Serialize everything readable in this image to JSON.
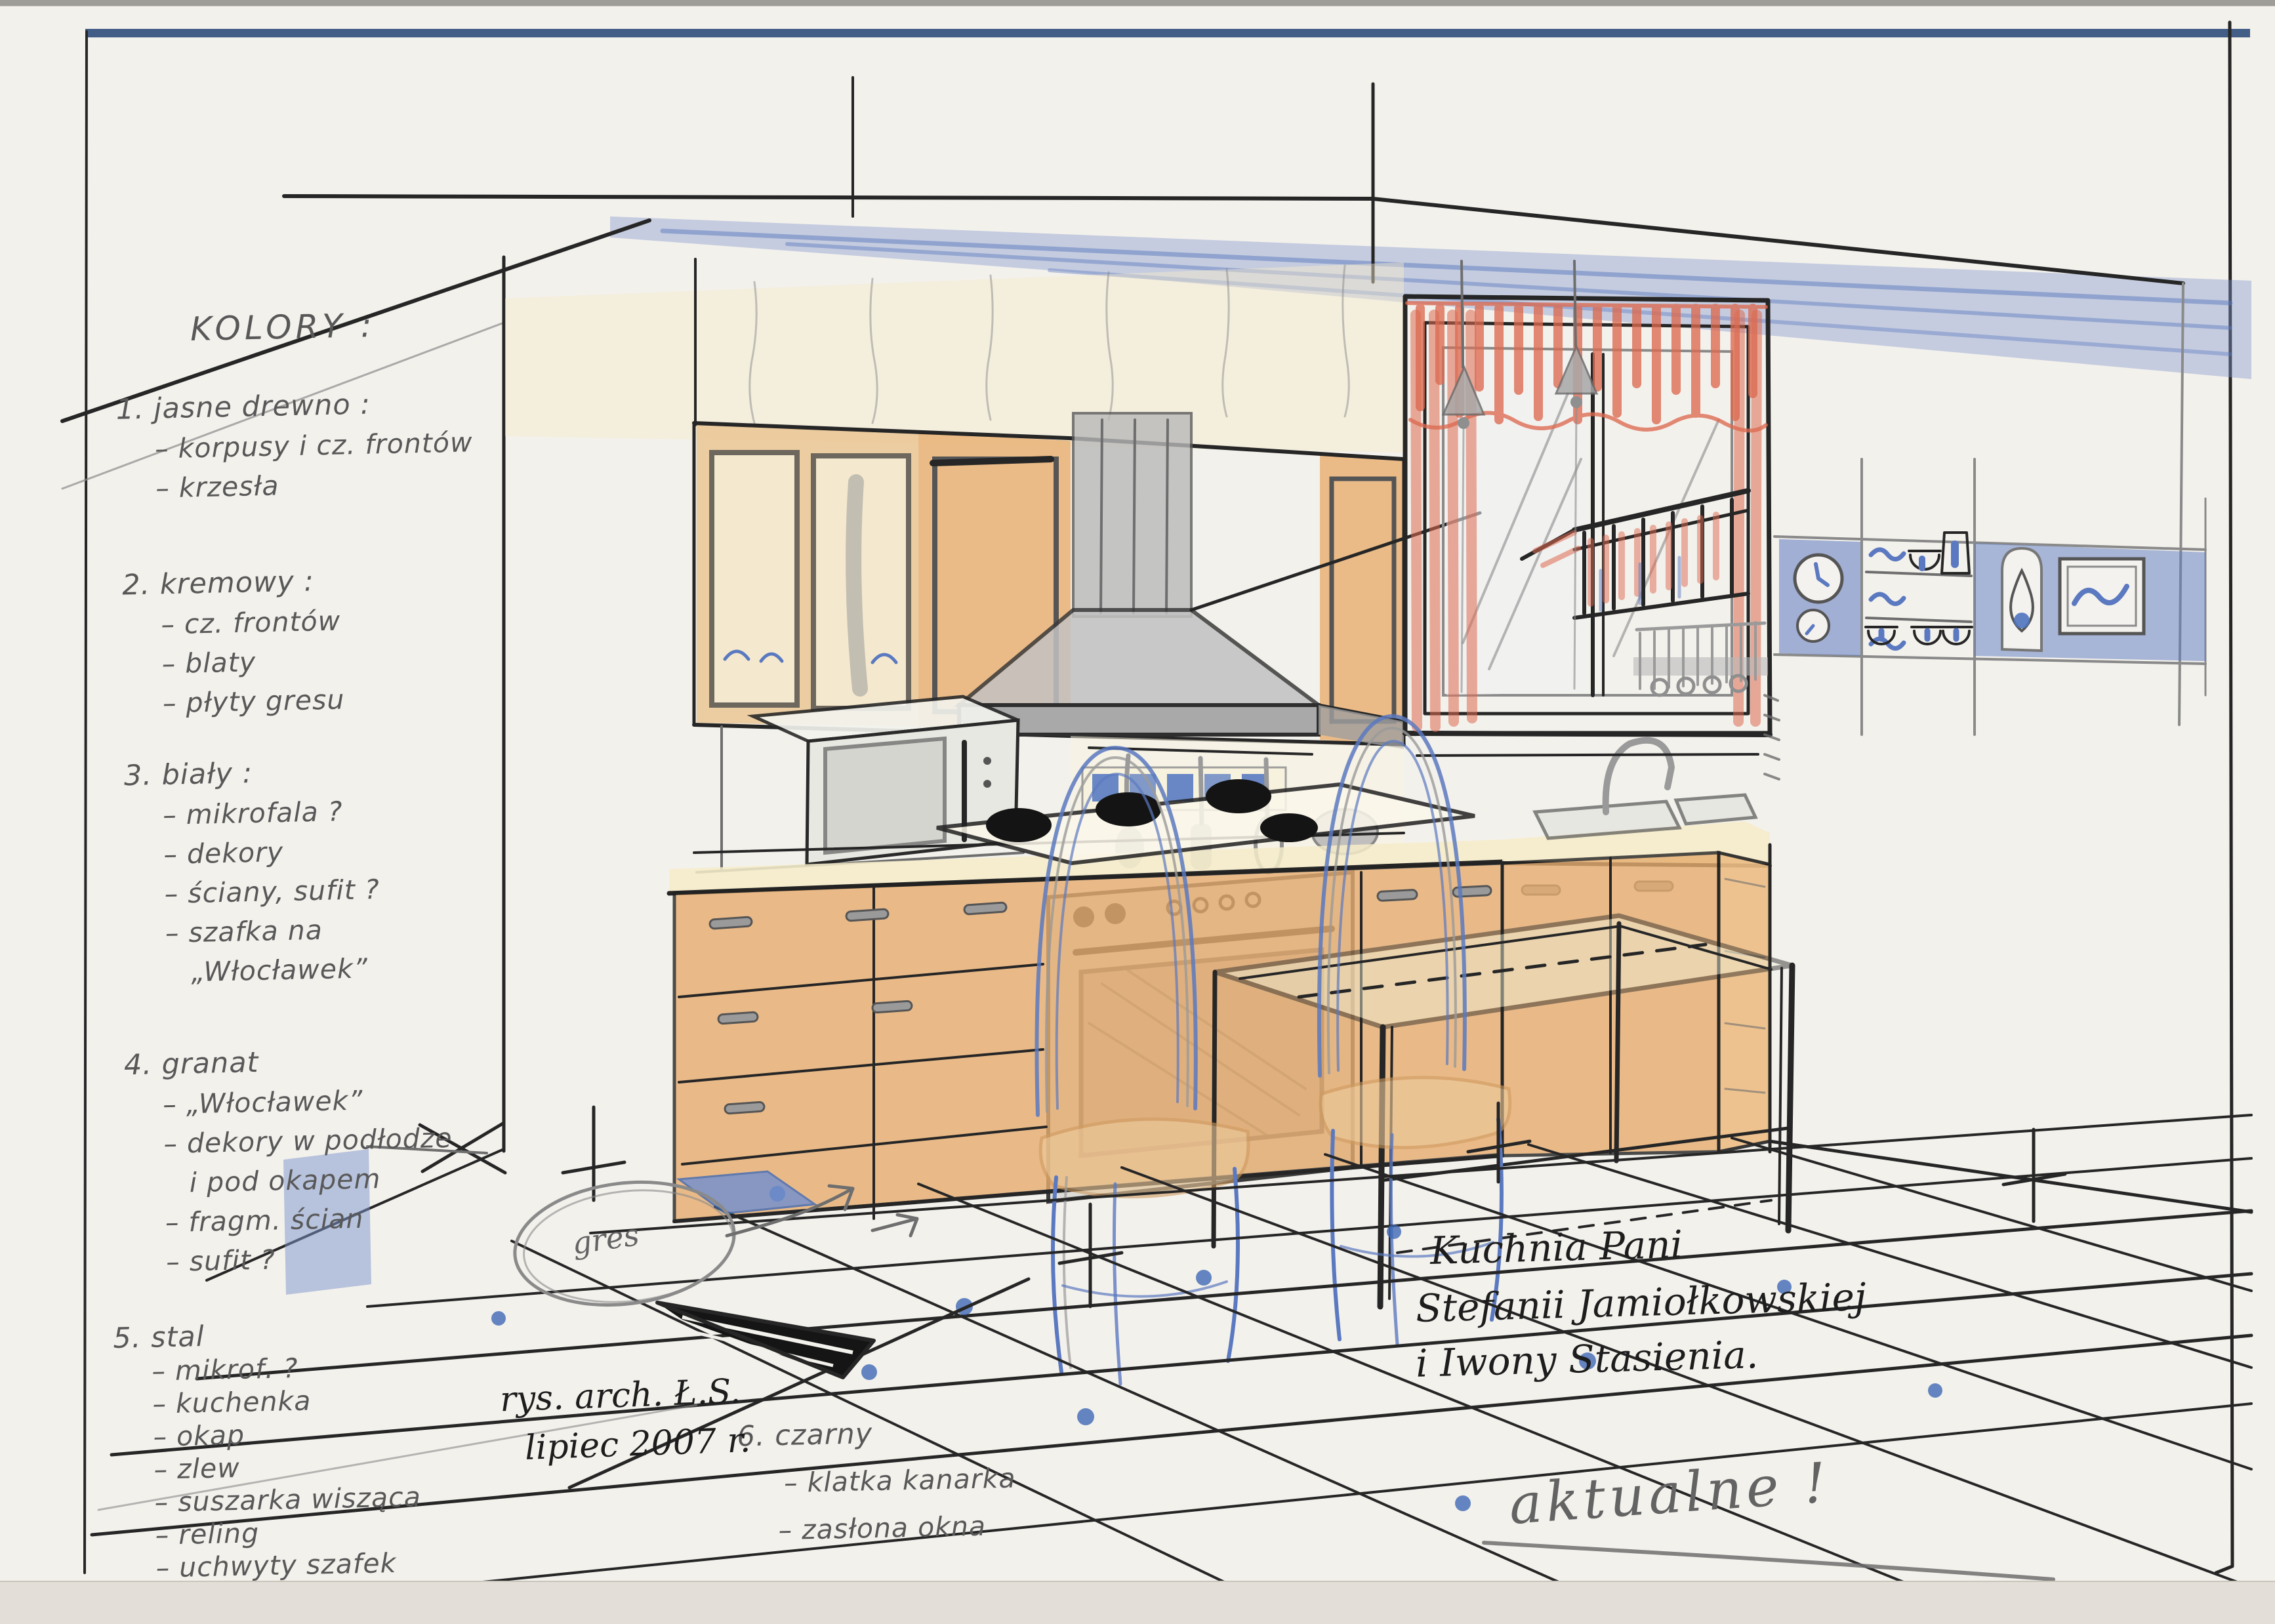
{
  "document": {
    "kind": "hand-drawn kitchen interior design sketch with color notes",
    "language": "Polish"
  },
  "palette": {
    "paper": "#f3f1ec",
    "frame_blue": "#33517e",
    "pencil_gray": "#585858",
    "ink_black": "#1d1d1d",
    "wood_orange": "#e7ad70",
    "cream": "#f6ecc9",
    "navy_blue": "#5b79c0",
    "steel_gray": "#b9b9b9",
    "curtain_red": "#dd6a50"
  },
  "notes": {
    "title": "KOLORY :",
    "items": [
      {
        "head": "1. jasne drewno :",
        "subs": [
          "– korpusy i cz. frontów",
          "– krzesła"
        ]
      },
      {
        "head": "2. kremowy :",
        "subs": [
          "– cz. frontów",
          "– blaty",
          "– płyty gresu"
        ]
      },
      {
        "head": "3. biały :",
        "subs": [
          "– mikrofala ?",
          "– dekory",
          "– ściany, sufit ?",
          "– szafka na",
          "„Włocławek”"
        ]
      },
      {
        "head": "4. granat",
        "subs": [
          "– „Włocławek”",
          "– dekory w podłodze",
          "i pod okapem",
          "– fragm. ścian",
          "– sufit ?"
        ]
      },
      {
        "head": "5. stal",
        "subs": [
          "– mikrof. ?",
          "– kuchenka",
          "– okap",
          "– zlew",
          "– suszarka wisząca",
          "– reling",
          "– uchwyty szafek"
        ]
      },
      {
        "head": "6. czarny",
        "subs": [
          "– klatka kanarka",
          "– zasłona okna"
        ]
      }
    ]
  },
  "annotations": {
    "floor_material_label": "gres",
    "signature_line1": "rys. arch. Ł.S.",
    "signature_line2": "lipiec 2007 r.",
    "project_title_line1": "Kuchnia Pani",
    "project_title_line2": "Stefanii Jamiołkowskiej",
    "project_title_line3": "i Iwony Stasienia.",
    "status_note": "aktualne !"
  }
}
